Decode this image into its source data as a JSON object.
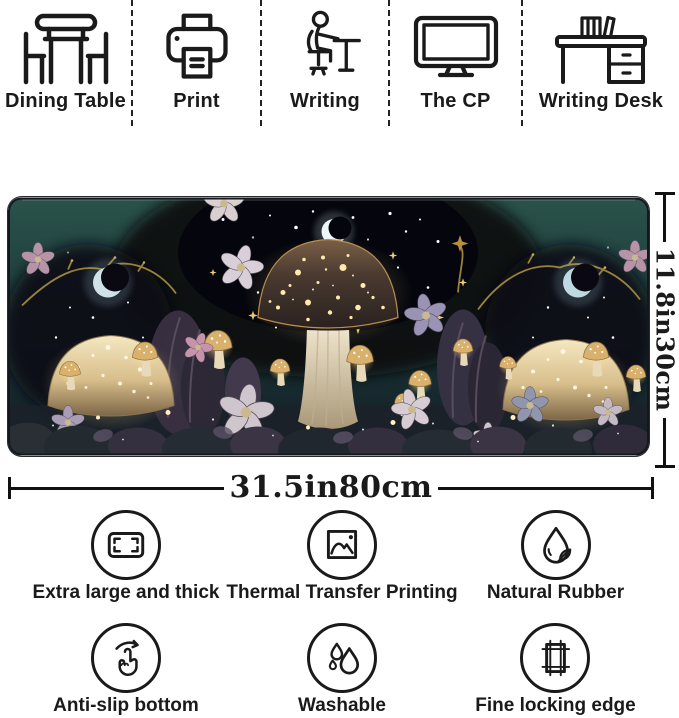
{
  "usage_row": {
    "items": [
      {
        "label": "Dining Table",
        "icon": "dining-table-icon"
      },
      {
        "label": "Print",
        "icon": "printer-icon"
      },
      {
        "label": "Writing",
        "icon": "writing-person-icon"
      },
      {
        "label": "The CP",
        "icon": "computer-monitor-icon"
      },
      {
        "label": "Writing Desk",
        "icon": "writing-desk-icon"
      }
    ]
  },
  "product": {
    "width_label": "31.5in80cm",
    "height_label": "11.8in30cm",
    "artwork_colors": {
      "mat_teal": "#24463f",
      "night_sky": "#0a0b14",
      "glow_gold": "#f0dca4",
      "moon": "#d7e6ea",
      "foliage_purple": "#3a3142",
      "mushroom_cream": "#e9d9ae"
    }
  },
  "features": {
    "items": [
      {
        "label": "Extra large and thick",
        "icon": "mat-size-icon"
      },
      {
        "label": "Thermal Transfer Printing",
        "icon": "photo-print-icon"
      },
      {
        "label": "Natural Rubber",
        "icon": "droplet-leaf-icon"
      },
      {
        "label": "Anti-slip bottom",
        "icon": "hand-swipe-icon"
      },
      {
        "label": "Washable",
        "icon": "water-drops-icon"
      },
      {
        "label": "Fine locking edge",
        "icon": "locking-edge-icon"
      }
    ]
  }
}
